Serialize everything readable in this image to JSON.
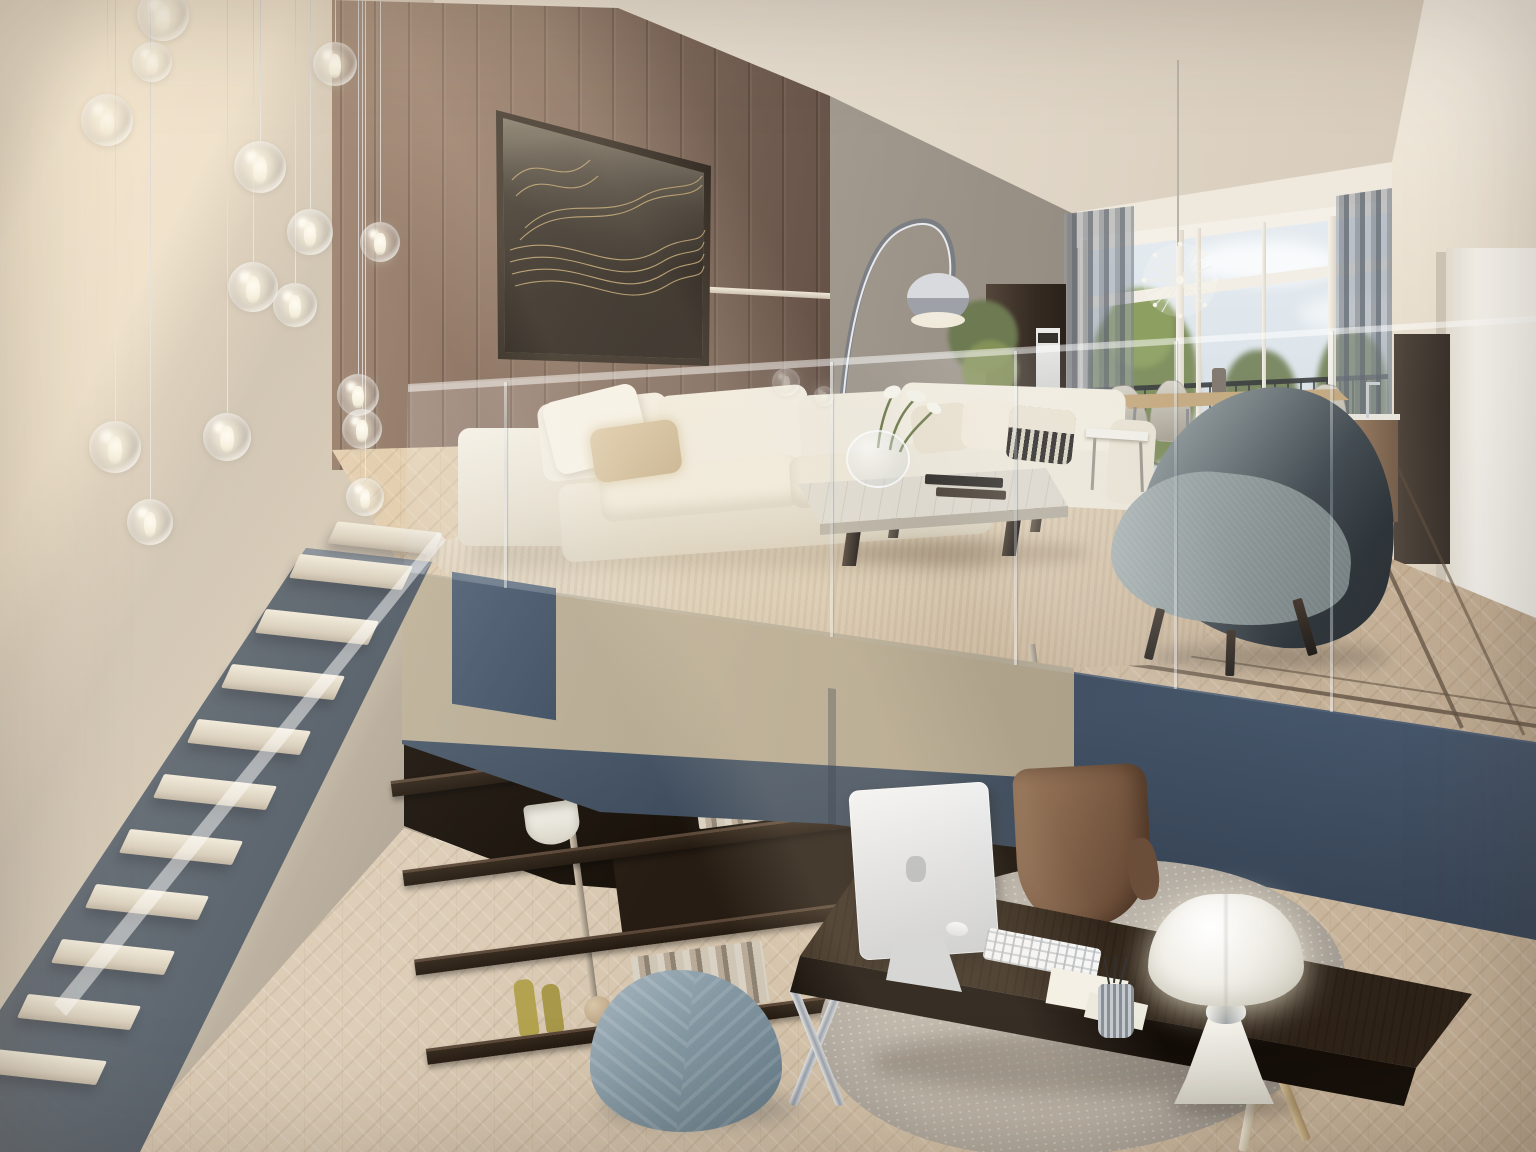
{
  "scene": {
    "type": "interior-architectural-render",
    "rooms": [
      "mezzanine-living-room",
      "lower-level-home-office"
    ],
    "objects": [
      "glass-bubble-pendant-lights",
      "concrete-wall",
      "wood-panel-wall",
      "abstract-artwork",
      "arc-floor-lamp",
      "oven-cabinet",
      "potted-plant",
      "white-sofa",
      "second-white-sofa",
      "patterned-pillow",
      "marble-coffee-table",
      "calla-lily-vase",
      "stacked-books",
      "shaggy-rug",
      "gray-wingback-armchair",
      "dining-table",
      "woven-dining-chairs",
      "sputnik-chandelier",
      "window-wall",
      "balcony-railing",
      "sheer-curtains",
      "white-wall-cabinet",
      "dark-cabinet",
      "kitchen-counter",
      "herringbone-parquet-floor",
      "inlay-border",
      "glass-balustrade",
      "mezzanine-fascia",
      "floating-staircase",
      "low-bookshelf",
      "shelf-decor-books-bottles-bowls",
      "dark-wood-desk",
      "computer-monitor",
      "keyboard",
      "mouse",
      "pen-cup",
      "note-papers",
      "pipistrello-table-lamp",
      "leather-desk-chair",
      "round-marble-rug",
      "quilted-pouf"
    ]
  },
  "palette": {
    "ceiling": "#e9e0d2",
    "concrete": "#cdc2b2",
    "wood": "#8d7463",
    "wood_dark": "#64513f",
    "art_gold": "#c0a36b",
    "art_dark": "#1b1510",
    "art_cream": "#ddd5c4",
    "gray_wall": "#aaa399",
    "sky": "#e8edf1",
    "foliage": "#7d8c5a",
    "curtain": "#8d939b",
    "cream_wall": "#f0e8da",
    "sofa": "#f2ede0",
    "rug_light": "#f5eedd",
    "rug_dark": "#a98f74",
    "armchair_light": "#97a1a2",
    "armchair_dark": "#272e33",
    "floor_mezz": "#ddc8aa",
    "floor_lower": "#d7c5ad",
    "inlay": "#5a4734",
    "fascia_beige": "#b5aa94",
    "fascia_blue": "#4a5a6e",
    "shelf_wood": "#31251b",
    "desk_wood": "#3f3125",
    "leather": "#7e5d45",
    "lamp_white": "#f7f5ef",
    "stair_steel": "#4c5866",
    "tread": "#e9e3d4",
    "pouf": "#8899a4",
    "chrome": "#c6cad0",
    "bottle_yellow": "#b0a150"
  }
}
